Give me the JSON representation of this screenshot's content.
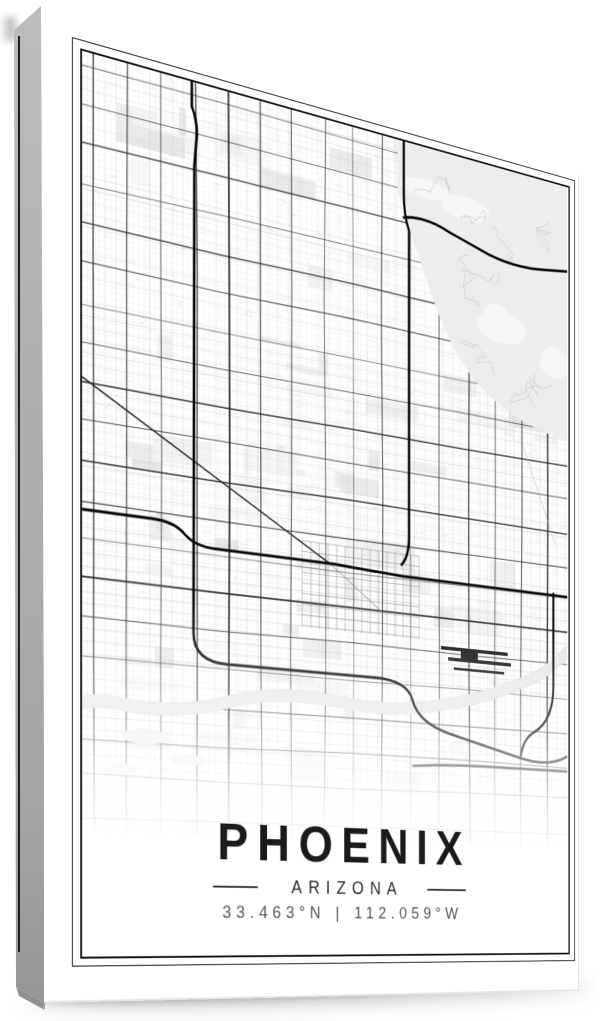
{
  "poster": {
    "title": "PHOENIX",
    "state": "ARIZONA",
    "coordinates": {
      "latitude": "33.463°N",
      "separator": "|",
      "longitude": "112.059°W"
    }
  },
  "style": {
    "border_color": "#121212",
    "title_color": "#1b1b1b",
    "state_color": "#2e2e2e",
    "coords_color": "#555555",
    "divider_color": "#333333",
    "canvas_side_color": "#adadad"
  },
  "map": {
    "seed": 11,
    "fine_spacing": 6.3,
    "medium_spacing": 12.7,
    "major_spacing_x": 39,
    "major_spacing_y": 40,
    "colors": {
      "minor": "#e1e1e1",
      "medium": "#c2c2c2",
      "major": "#2b2b2b",
      "highway": "#060606",
      "terrain": "#ededed",
      "terrain_road": "#c9c9c9",
      "river": "#e8e8e8",
      "runway": "#1b1b1b",
      "block": [
        "#f3f3f3",
        "#ececec",
        "#e6e6e6"
      ]
    },
    "highways": [
      "M0,464 H78 Q104,464 116,476 Q128,487 152,487 H300 Q340,489 390,491 H626",
      "M124,0 L124,26 Q130,38 130,54 L127,88 L126,578 Q126,608 166,608 H352",
      "M352,608 Q396,608 403,630 Q411,655 455,665 L558,688 Q600,696 626,682",
      "M391,0 L391,58 Q391,84 398,99 L398,446 Q398,468 388,478",
      "M391,86 Q420,78 455,90 L510,104 Q550,112 590,106 L626,101",
      "M605,489 L605,600 Q605,640 576,656 Q560,664 556,686",
      "M404,704 Q450,700 500,700 L626,700"
    ],
    "diagonal": "M0,330 L295,488",
    "rail": "M295,488 L362,534",
    "river_path": "M626,556 Q600,583 560,598 Q500,623 440,633 Q380,646 300,638 Q220,630 160,650 Q100,666 40,658 Q20,655 0,660",
    "terrain_path": "M383,0 L626,0 L626,303 Q560,298 510,268 Q460,238 430,168 Q405,113 383,58 Z",
    "runways": [
      [
        442,
        565,
        95,
        4
      ],
      [
        452,
        577,
        90,
        4
      ],
      [
        460,
        588,
        72,
        3
      ],
      [
        470,
        569,
        24,
        11
      ]
    ]
  }
}
